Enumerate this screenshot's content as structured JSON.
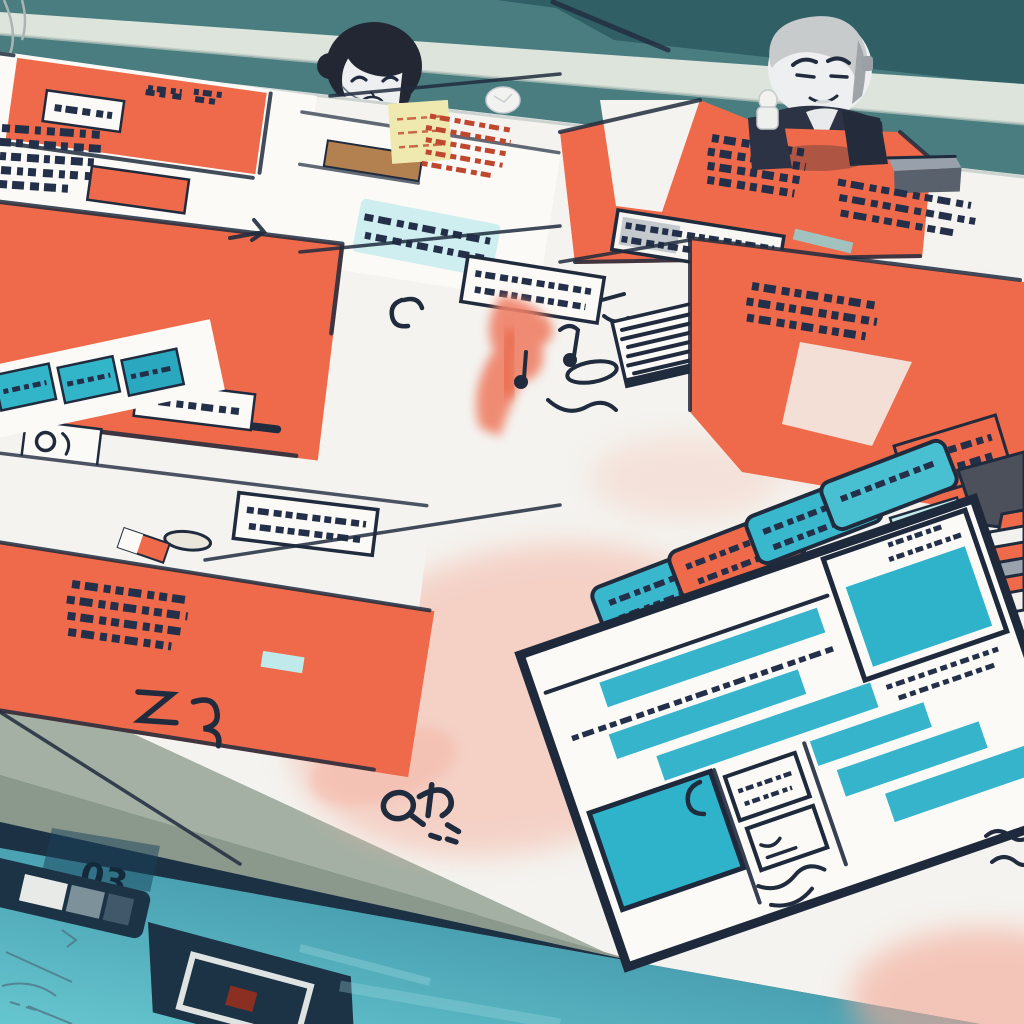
{
  "illustration": {
    "kind": "stylized-illustration",
    "subject": "planning table covered with wireframe documents, two chibi characters peeking over the edge"
  },
  "palette": {
    "wall_teal": "#4a7d80",
    "wall_teal_dark": "#305f66",
    "beam_light": "#dde4dc",
    "table_white": "#f4f3ef",
    "paper_white": "#fbfaf7",
    "coral": "#ee6a4a",
    "coral_soft": "#f2907b",
    "pink_wash": "#f5b5a4",
    "ink_navy": "#202b3e",
    "teal_accent": "#35b4cc",
    "teal_pale": "#cfeef0",
    "yellow_note": "#efe9b0",
    "red_scribble": "#bf4730",
    "slab_gray": "#a3b0a3",
    "slab_gray_dark": "#8b988c",
    "floor_navy": "#1c3346",
    "floor_teal_top": "#2e7c94",
    "floor_teal_bottom": "#66c6cf",
    "hair_black": "#232733",
    "hair_gray": "#c8cbcc",
    "face_pale": "#edeff0",
    "suit_dark": "#2b3344",
    "easel_tan": "#b3814f"
  },
  "characters": [
    {
      "id": "presenter-left",
      "hair": "black bun",
      "expression": "closed-eye smile",
      "outfit": "dark suit, striped tie"
    },
    {
      "id": "presenter-right",
      "hair": "gray swept back",
      "expression": "smirk",
      "outfit": "dark suit, arms on table"
    }
  ],
  "floor": {
    "screen_glyph": "03"
  },
  "objects": [
    "coral-wireframe-sheets",
    "scribble-text-blocks",
    "teal-highlight-strip",
    "yellow-sticky-note",
    "barcode-block",
    "pill-chip-column",
    "paper-stack",
    "wireframe-document",
    "stapler",
    "paper-crumples",
    "pink-watercolor-washes",
    "floor-reflection-screens",
    "wire-curls"
  ]
}
